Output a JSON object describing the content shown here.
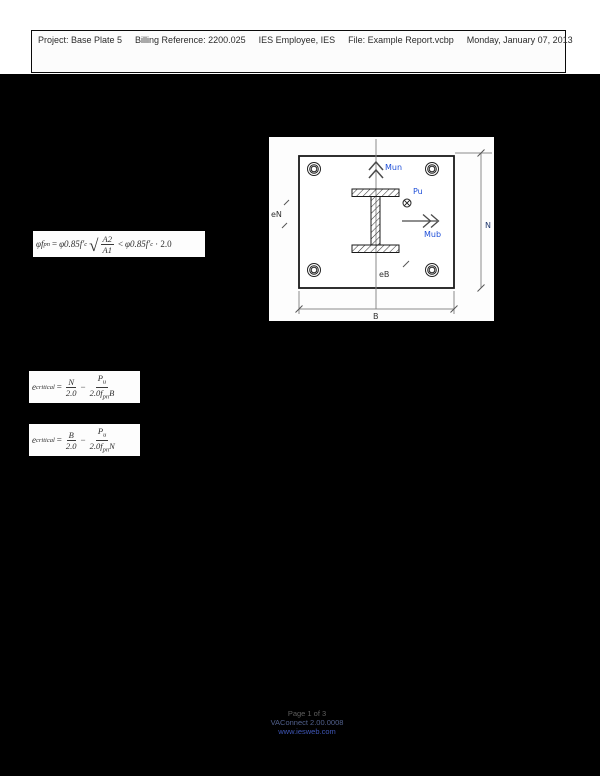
{
  "header": {
    "segments": [
      "Project:  Base Plate 5",
      "Billing Reference: 2200.025",
      "IES Employee, IES",
      "File: Example Report.vcbp",
      "Monday, January 07, 2013"
    ]
  },
  "formula_bearing": {
    "lhs": "φf",
    "lhs_sub": "pn",
    "equals": "=",
    "t1": "φ0.85f′",
    "t1_sub": "c",
    "radical": "√",
    "rad_num": "A2",
    "rad_den": "A1",
    "less_than": "<",
    "t2": "φ0.85f′",
    "t2_sub": "c",
    "factor": "· 2.0"
  },
  "formula_ecrit_n": {
    "lhs": "e",
    "lhs_sub": "critical",
    "equals": "=",
    "f1_num": "N",
    "f1_den": "2.0",
    "minus": "−",
    "f2_num": "P",
    "f2_num_sub": "u",
    "f2_den_a": "2.0f",
    "f2_den_sub": "pn",
    "f2_den_b": "B"
  },
  "formula_ecrit_b": {
    "lhs": "e",
    "lhs_sub": "critical",
    "equals": "=",
    "f1_num": "B",
    "f1_den": "2.0",
    "minus": "−",
    "f2_num": "P",
    "f2_num_sub": "u",
    "f2_den_a": "2.0f",
    "f2_den_sub": "pn",
    "f2_den_b": "N"
  },
  "diagram": {
    "labels": {
      "mun": "Mun",
      "pu": "Pu",
      "mub": "Mub",
      "en": "eN",
      "eb": "eB",
      "dim_n": "N",
      "dim_b": "B"
    },
    "colors": {
      "load_label": "#1f4fd8",
      "dim_n_label": "#22396e",
      "small_label": "#333333",
      "line": "#3a3a3a",
      "dim_line": "#8a8a8a"
    }
  },
  "footer": {
    "page": "Page 1 of 3",
    "app": "VAConnect 2.00.0008",
    "site": "www.iesweb.com"
  }
}
